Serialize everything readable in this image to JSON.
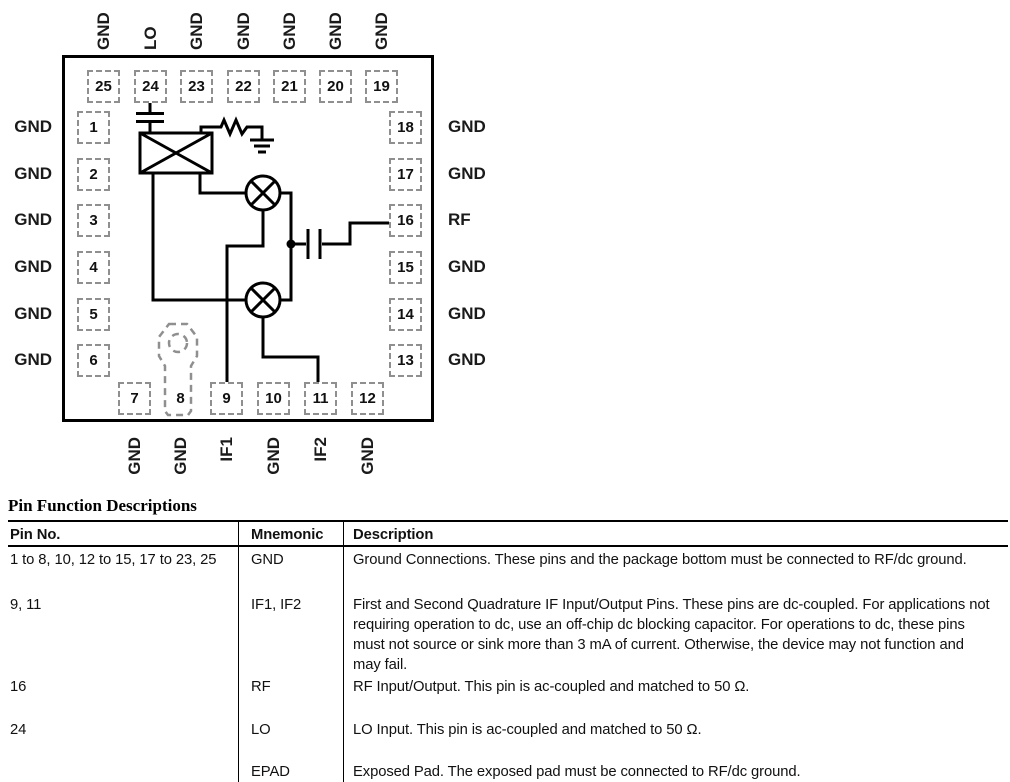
{
  "package": {
    "top_pins": [
      {
        "num": "25",
        "label": "GND"
      },
      {
        "num": "24",
        "label": "LO"
      },
      {
        "num": "23",
        "label": "GND"
      },
      {
        "num": "22",
        "label": "GND"
      },
      {
        "num": "21",
        "label": "GND"
      },
      {
        "num": "20",
        "label": "GND"
      },
      {
        "num": "19",
        "label": "GND"
      }
    ],
    "left_pins": [
      {
        "num": "1",
        "label": "GND"
      },
      {
        "num": "2",
        "label": "GND"
      },
      {
        "num": "3",
        "label": "GND"
      },
      {
        "num": "4",
        "label": "GND"
      },
      {
        "num": "5",
        "label": "GND"
      },
      {
        "num": "6",
        "label": "GND"
      }
    ],
    "right_pins": [
      {
        "num": "18",
        "label": "GND"
      },
      {
        "num": "17",
        "label": "GND"
      },
      {
        "num": "16",
        "label": "RF"
      },
      {
        "num": "15",
        "label": "GND"
      },
      {
        "num": "14",
        "label": "GND"
      },
      {
        "num": "13",
        "label": "GND"
      }
    ],
    "bottom_pins": [
      {
        "num": "7",
        "label": "GND"
      },
      {
        "num": "8",
        "label": "GND"
      },
      {
        "num": "9",
        "label": "IF1"
      },
      {
        "num": "10",
        "label": "GND"
      },
      {
        "num": "11",
        "label": "IF2"
      },
      {
        "num": "12",
        "label": "GND"
      }
    ],
    "schematic_elements": [
      "lo-coupling-capacitor",
      "lo-balun",
      "lo-termination-resistor",
      "ground-symbol",
      "mixer-1",
      "mixer-2",
      "rf-coupling-capacitor",
      "junction-dot",
      "exposed-pad-symbol"
    ]
  },
  "table": {
    "title": "Pin Function Descriptions",
    "headers": {
      "pin": "Pin No.",
      "mnemonic": "Mnemonic",
      "description": "Description"
    },
    "rows": [
      {
        "pin": "1 to 8, 10, 12 to 15, 17 to 23, 25",
        "mnemonic": "GND",
        "description": "Ground Connections. These pins and the package bottom must be connected to RF/dc ground."
      },
      {
        "pin": "9, 11",
        "mnemonic": "IF1, IF2",
        "description": "First and Second Quadrature IF Input/Output Pins. These pins are dc-coupled. For applications not requiring operation to dc, use an off-chip dc blocking capacitor. For operations to dc, these pins must not source or sink more than 3 mA of current. Otherwise, the device may not function and may fail."
      },
      {
        "pin": "16",
        "mnemonic": "RF",
        "description": "RF Input/Output. This pin is ac-coupled and matched to 50 Ω."
      },
      {
        "pin": "24",
        "mnemonic": "LO",
        "description": "LO Input. This pin is ac-coupled and matched to 50 Ω."
      },
      {
        "pin": "",
        "mnemonic": "EPAD",
        "description": "Exposed Pad. The exposed pad must be connected to RF/dc ground."
      }
    ]
  },
  "colors": {
    "line": "#000000",
    "pin_box_dash": "#8f8f8f",
    "text": "#111111"
  }
}
